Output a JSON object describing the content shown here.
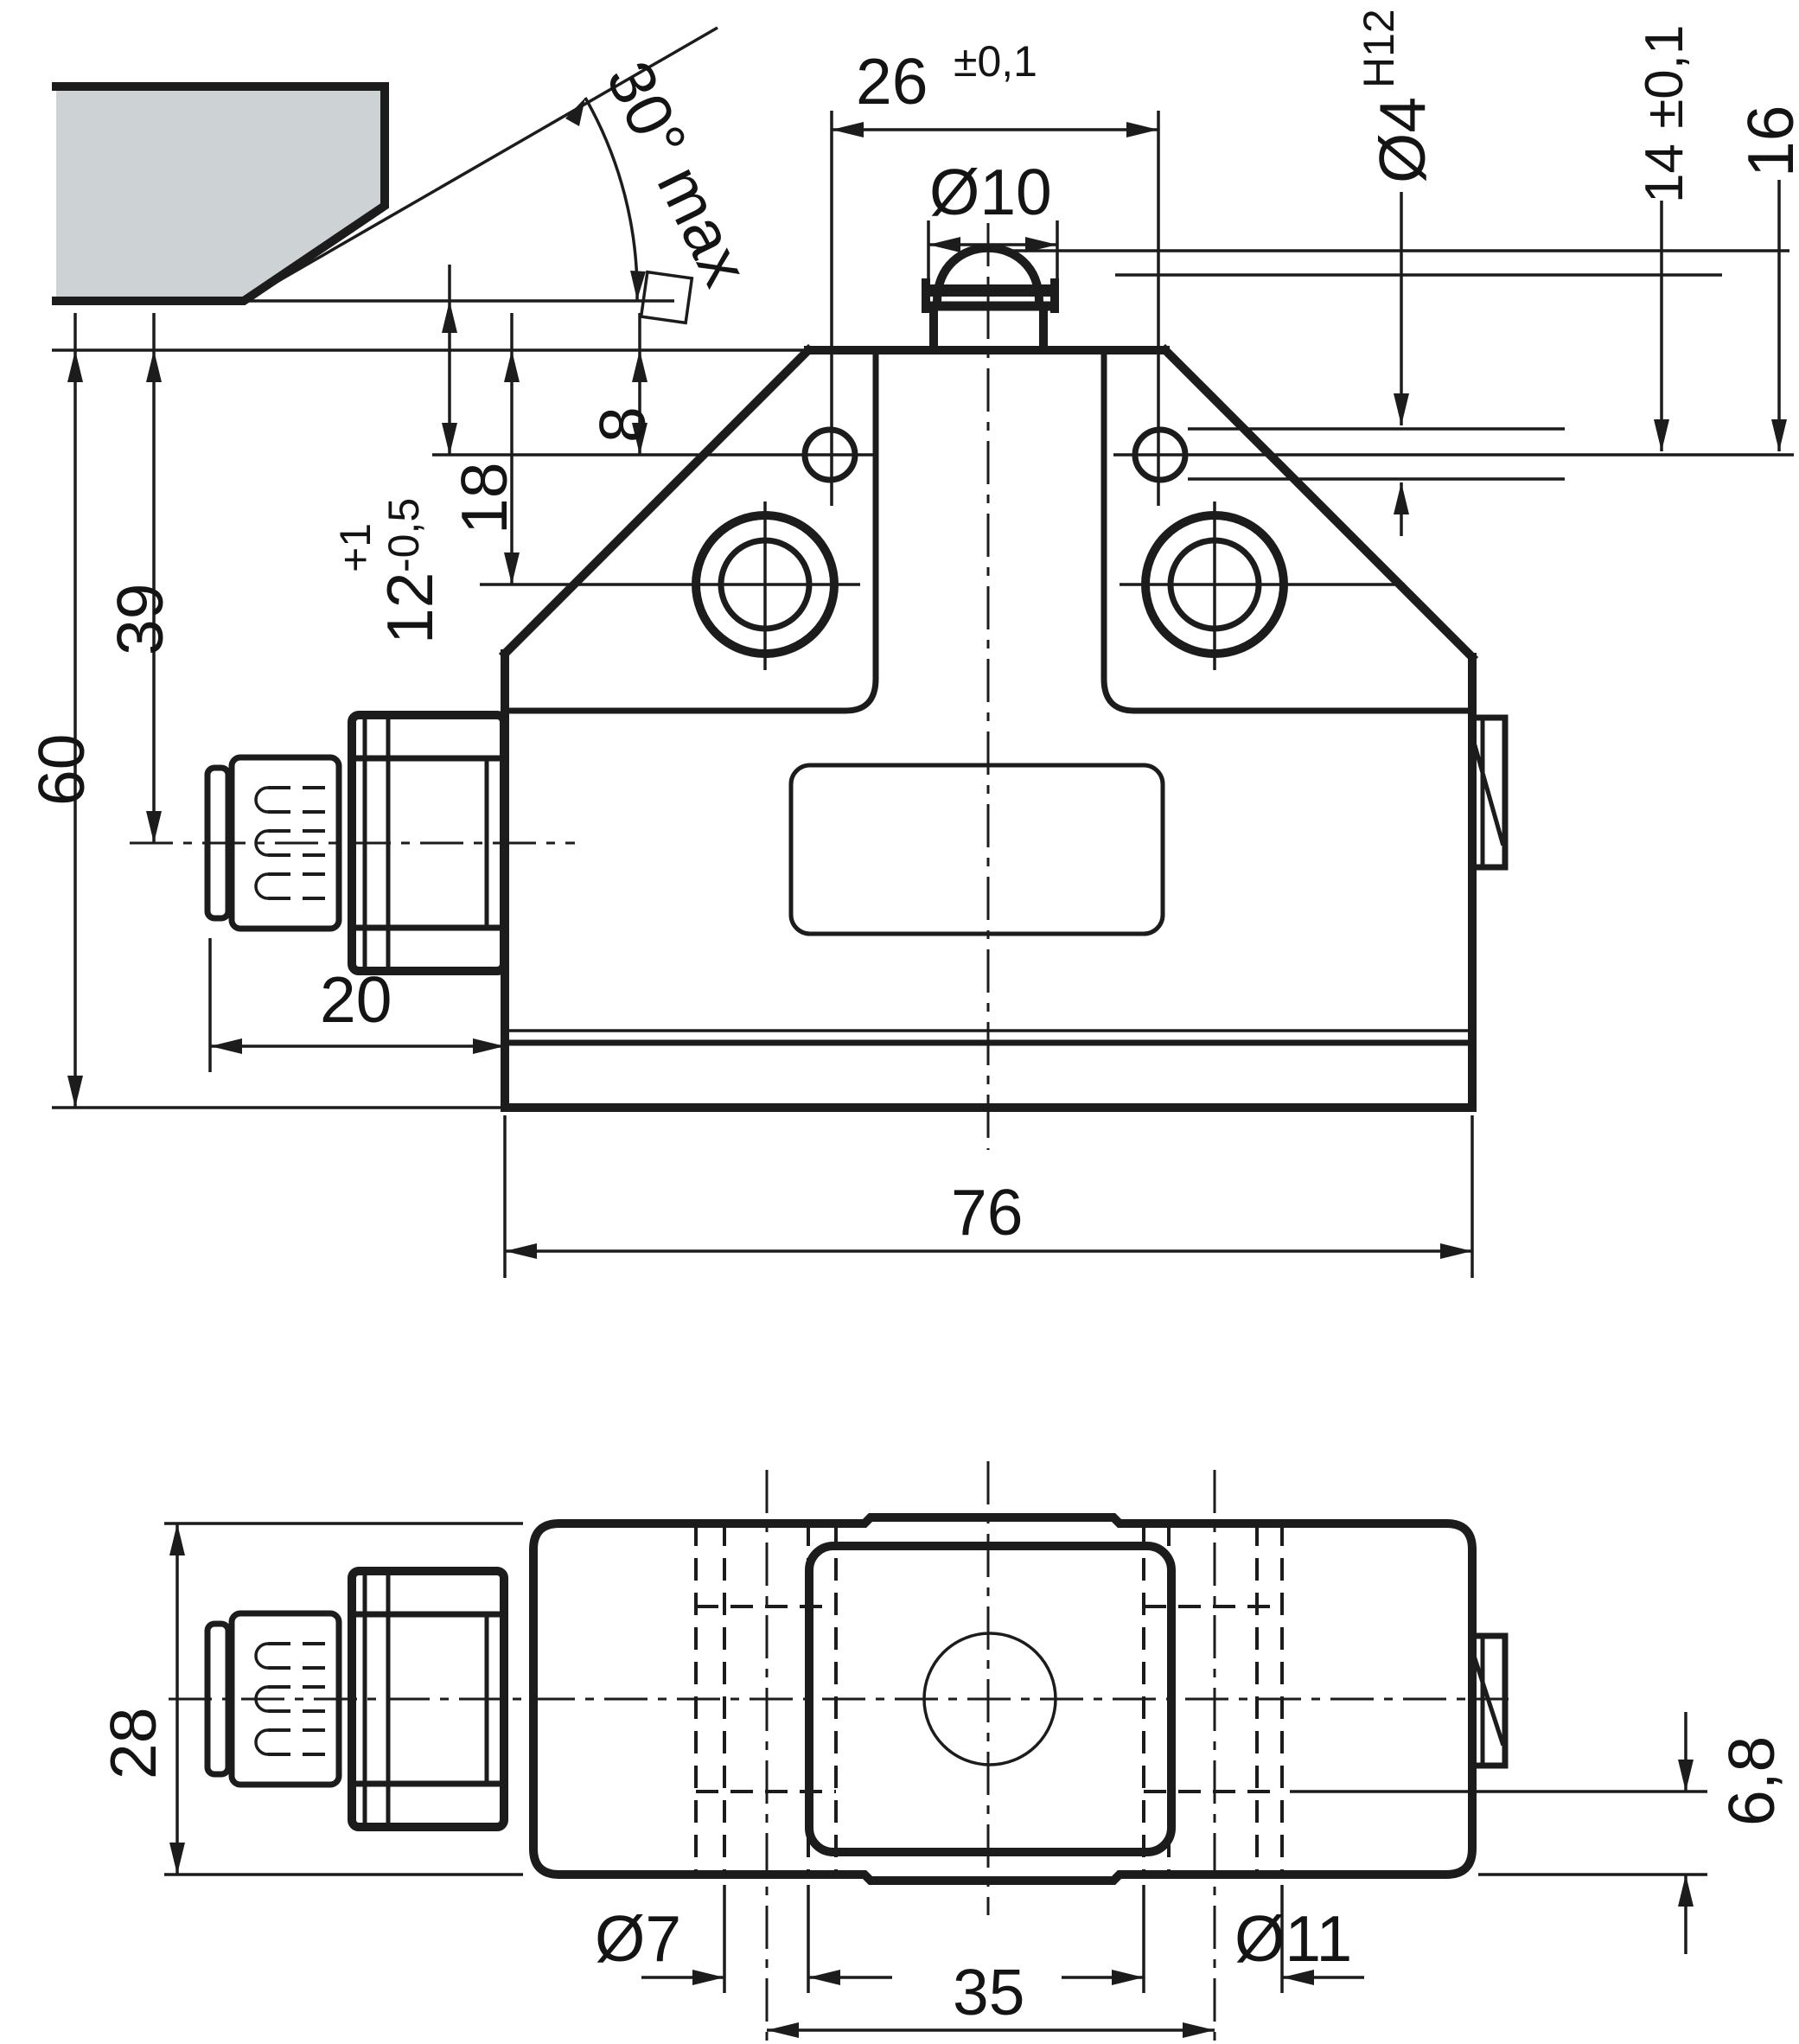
{
  "drawing": {
    "title": "limit-switch-dimension-drawing",
    "views": [
      "front-view",
      "bottom-view"
    ],
    "colors": {
      "line": "#1c1c1c",
      "plate_fill": "#cdd3d4",
      "background": "#ffffff"
    },
    "labels": {
      "dim_26": "26",
      "dim_26_tol": "±0,1",
      "dim_d10": "Ø10",
      "dim_d4": "Ø4",
      "dim_d4_fit": "H12",
      "dim_14": "14 ±0,1",
      "dim_16": "16",
      "dim_30": "30° max",
      "dim_12": "12",
      "dim_12_plus": "+1",
      "dim_12_minus": "-0,5",
      "dim_18": "18",
      "dim_8": "8",
      "dim_39": "39",
      "dim_60": "60",
      "dim_20": "20",
      "dim_76": "76",
      "dim_28": "28",
      "dim_d7": "Ø7",
      "dim_35": "35",
      "dim_d11": "Ø11",
      "dim_68": "6,8"
    }
  }
}
